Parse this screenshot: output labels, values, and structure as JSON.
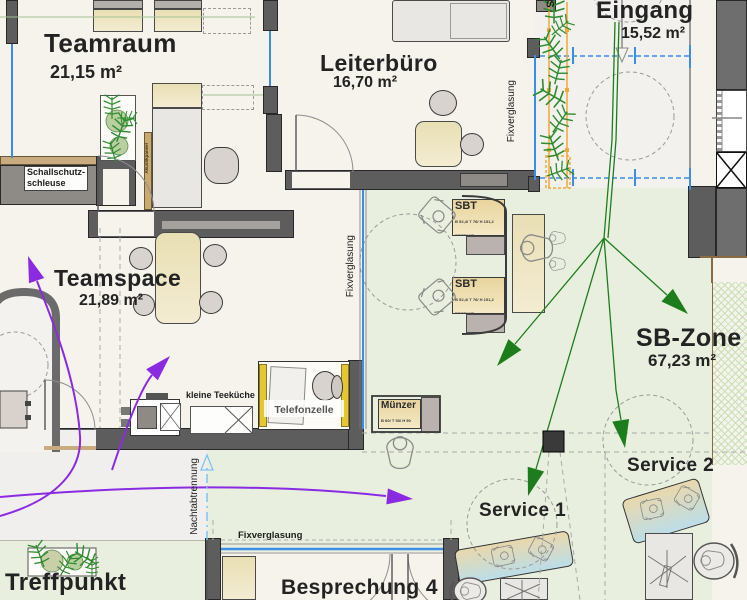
{
  "rooms": {
    "teamraum": {
      "name": "Teamraum",
      "area": "21,15 m²"
    },
    "leiterbuero": {
      "name": "Leiterbüro",
      "area": "16,70 m²"
    },
    "eingang": {
      "name": "Eingang",
      "area": "15,52 m²"
    },
    "teamspace": {
      "name": "Teamspace",
      "area": "21,89 m²"
    },
    "sb_zone": {
      "name": "SB-Zone",
      "area": "67,23 m²"
    },
    "service1": {
      "name": "Service 1"
    },
    "service2": {
      "name": "Service 2"
    },
    "besprechung4": {
      "name": "Besprechung 4"
    },
    "treffpunkt": {
      "name": "Treffpunkt"
    }
  },
  "annotations": {
    "schallschutz_line1": "Schallschutz-",
    "schallschutz_line2": "schleuse",
    "fixverglasung": "Fixverglasung",
    "nachtabtrennung": "Nachtabtrennung",
    "akustikpaneel": "Akustikpaneel",
    "kleine_teekueche": "kleine Teeküche",
    "telefonzelle": "Telefonzelle",
    "stair_fragment": "S"
  },
  "equipment": {
    "sbt1": {
      "title": "SBT",
      "dims": "B 52,4/ T 76/ H 151,2",
      "status": "BESTAND"
    },
    "sbt2": {
      "title": "SBT",
      "dims": "B 52,4/ T 76/ H 151,2",
      "status": "BESTAND"
    },
    "muenzer": {
      "title": "Münzer",
      "dims": "B 60/ T 50/ H 90",
      "status": "BESTAND"
    }
  },
  "colors": {
    "wall": "#5d5d5d",
    "glazing_blue": "#3b8de8",
    "zone_green": "#e9efde",
    "arrow_green": "#1d7d1d",
    "arrow_purple": "#8a2be2",
    "planter_orange": "#f0a83a",
    "desk_beige": "#ece5c2",
    "booth_yellow": "#e6c733",
    "nacht_blue": "#7fc4f5"
  }
}
